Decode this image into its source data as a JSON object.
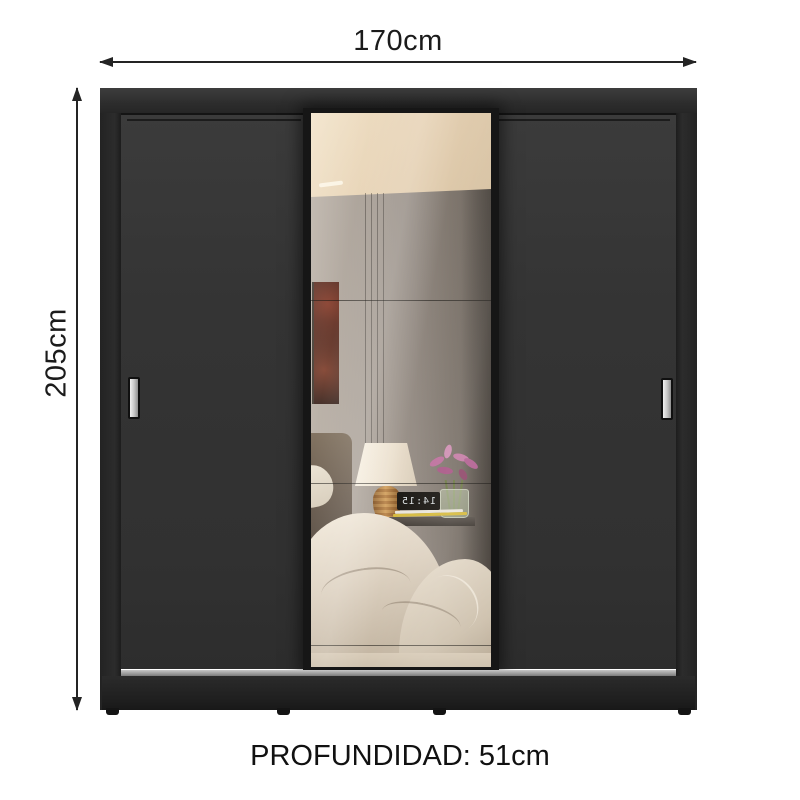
{
  "annotations": {
    "width_label": "170cm",
    "height_label": "205cm",
    "depth_label": "PROFUNDIDAD: 51cm"
  },
  "mirror_scene": {
    "clock_time": "14:15"
  },
  "colors": {
    "background": "#ffffff",
    "dimension_lines": "#242424",
    "wardrobe_body": "#343434",
    "wardrobe_sides": "#262626",
    "handles": "#c9c9c9",
    "sliding_track": "#9b9b9b",
    "mirror_ceiling": "#e9d6ba",
    "mirror_wall": "#958c83",
    "lamp_shade": "#f2ebde",
    "lamp_base": "#b5742e",
    "flowers": "#bf6f9e",
    "bedding": "#d9cdbc",
    "clock_display": "#16130f"
  }
}
